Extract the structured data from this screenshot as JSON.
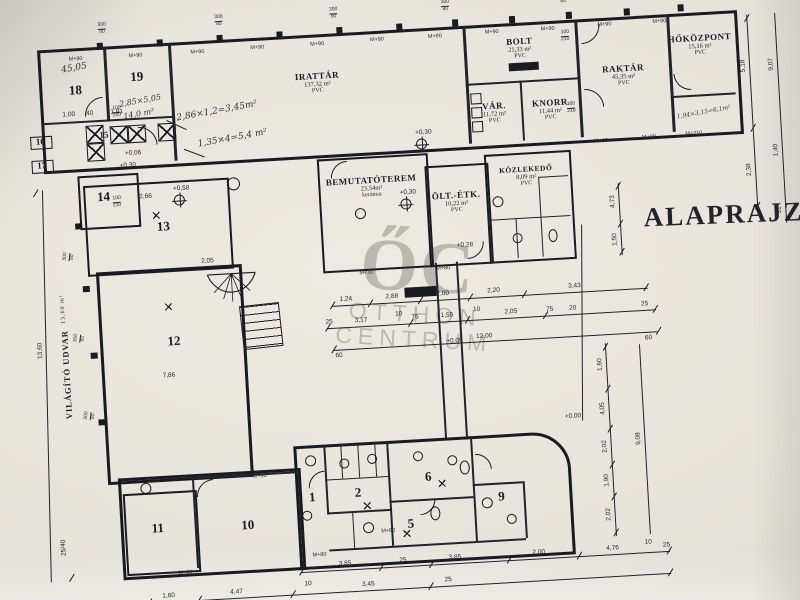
{
  "title": "ALAPRAJZ",
  "watermark": {
    "initials": "ŐC",
    "line1": "OTTHON",
    "line2": "CENTRUM"
  },
  "labels": {
    "window_head": "M+90",
    "door_sill": "M+210",
    "door_sill2": "M+80",
    "door_sill3": "M+30",
    "door_w": "100",
    "door_h": "210",
    "win_w": "300",
    "win_h": "80"
  },
  "rooms": {
    "r18": {
      "num": "18"
    },
    "r19": {
      "num": "19"
    },
    "r15": {
      "num": "15"
    },
    "r16": {
      "num": "16"
    },
    "r17": {
      "num": "17"
    },
    "irattar": {
      "name": "IRATTÁR",
      "area": "137,32 m²",
      "floor": "PVC"
    },
    "bolt": {
      "name": "BOLT",
      "area": "21,33 m²",
      "floor": "PVC"
    },
    "var": {
      "name": "VÁR.",
      "area": "11,72 m²",
      "floor": "PVC"
    },
    "knorr": {
      "name": "KNORR",
      "area": "11,44 m²",
      "floor": "PVC"
    },
    "raktar": {
      "name": "RAKTÁR",
      "area": "45,35 m²",
      "floor": "PVC"
    },
    "hokozpont": {
      "name": "HŐKÖZPONT",
      "area": "15,16 m²",
      "floor": "PVC"
    },
    "bemutatoterem": {
      "name": "BEMUTATÓTEREM",
      "area": "23,54m²",
      "floor": "kerámia"
    },
    "olt_etk": {
      "name": "ÖLT.-ÉTK.",
      "area": "10,22 m²",
      "floor": "PVC"
    },
    "kozlekedo": {
      "name": "KÖZLEKEDŐ",
      "area": "8,09 m²",
      "floor": "PVC"
    },
    "r14": {
      "num": "14"
    },
    "r13": {
      "num": "13"
    },
    "r12": {
      "num": "12"
    },
    "r11": {
      "num": "11"
    },
    "r10": {
      "num": "10"
    },
    "r1": {
      "num": "1"
    },
    "r2": {
      "num": "2"
    },
    "r5": {
      "num": "5"
    },
    "r6": {
      "num": "6"
    },
    "r9": {
      "num": "9"
    }
  },
  "handwritten": {
    "n1": "45,05",
    "n2": "2,85×5,05",
    "n3": "14,0 m²",
    "n4": "2,86×1,2=3,45m²",
    "n5": "1,35×4=5,4 m²",
    "n6": "1,94×3,15=6,1m²"
  },
  "side_label": {
    "name": "VILÁGÍTÓ UDVAR",
    "area": "13,60 m²"
  },
  "elevations": {
    "e1": "+0,30",
    "e2": "+0,58",
    "e3": "+0,28",
    "e4": "+0,06",
    "e5": "+0,09",
    "e6": "+0,00",
    "e7": "+0,30",
    "e8": "+0,30"
  },
  "dims": {
    "mid_row1": [
      "1,24",
      "2,88",
      "2,00",
      "2,20",
      "3,43"
    ],
    "mid_row2": [
      "25",
      "3,17",
      "10",
      "75",
      "1,55",
      "10",
      "2,05",
      "75",
      "20",
      "25"
    ],
    "mid_row3": [
      "60",
      "12,00",
      "60"
    ],
    "bottom_row1": [
      "3,85",
      "25",
      "3,85",
      "2,00",
      "4,76",
      "10",
      "25"
    ],
    "bottom_row2": [
      "1,60",
      "4,47",
      "10",
      "3,45",
      "25"
    ],
    "right_chain": [
      "1,60",
      "4,05",
      "2,02",
      "1,90",
      "2,02",
      "9,08"
    ],
    "right_upper1": [
      "5,18",
      "2,38"
    ],
    "right_upper2": [
      "9,07",
      "1,40",
      "31"
    ],
    "title_chain": [
      "4,73",
      "1,50"
    ],
    "left_outer": [
      "13,60",
      "25/40"
    ],
    "r13": "2,66",
    "r12a": "2,05",
    "r12b": "7,86",
    "r18": [
      "1,00",
      "40",
      "1,81"
    ]
  }
}
